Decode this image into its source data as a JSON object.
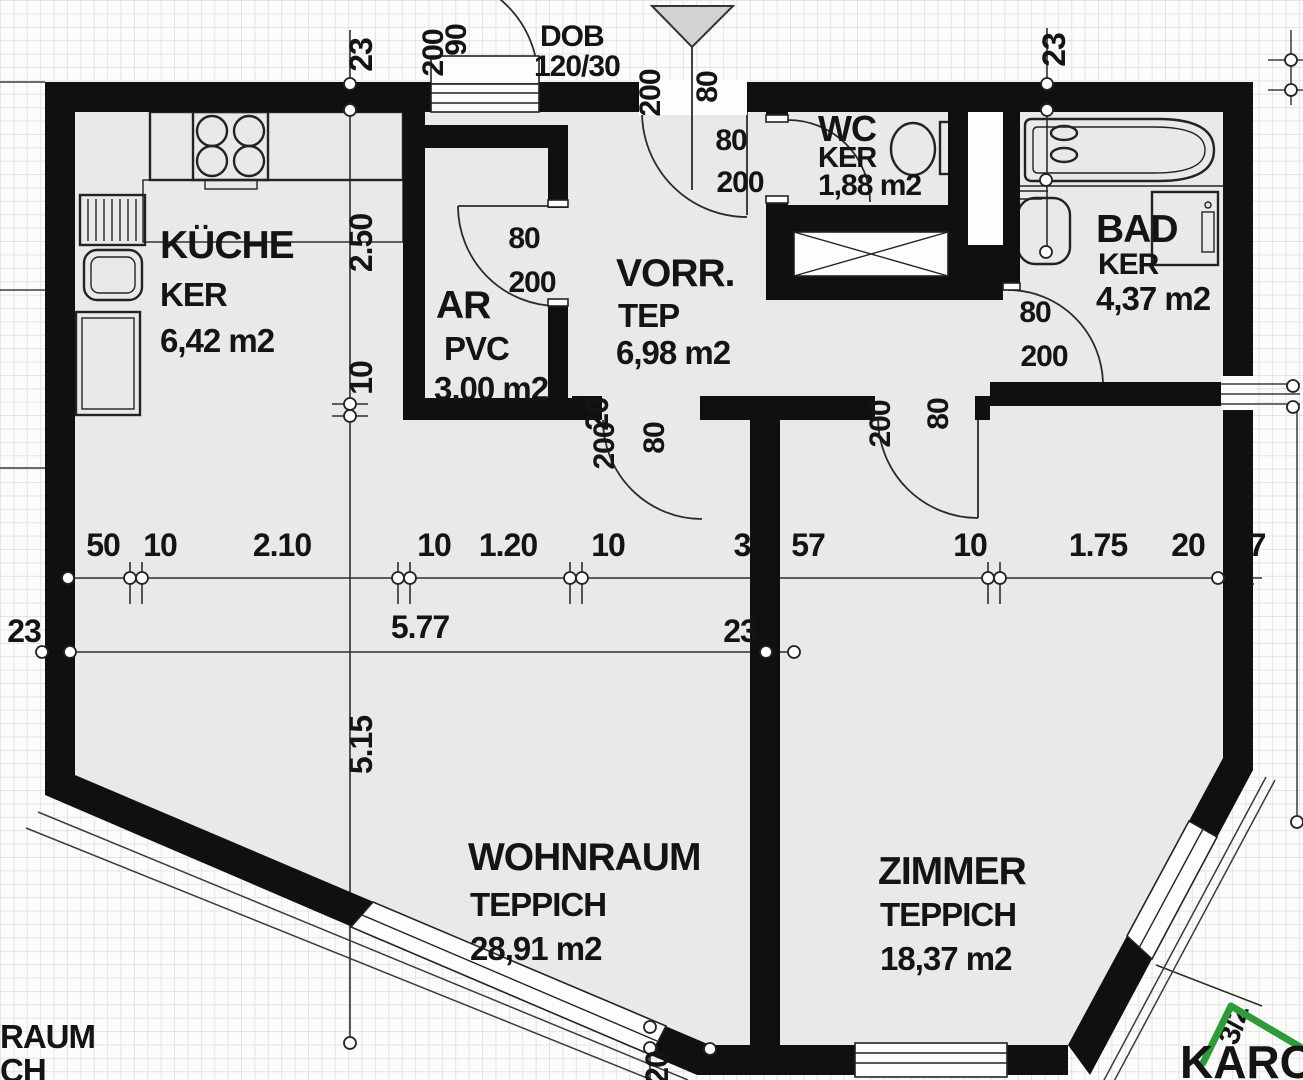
{
  "meta": {
    "title": "Apartment floor plan scan",
    "type": "floorplan"
  },
  "colors": {
    "wall": "#101010",
    "floor": "#e9e9e7",
    "paper": "#fcfcfa",
    "logo_green": "#2e9b38"
  },
  "rooms": {
    "kueche": {
      "name": "KÜCHE",
      "floor": "KER",
      "area": "6,42 m2"
    },
    "ar": {
      "name": "AR",
      "floor": "PVC",
      "area": "3,00 m2"
    },
    "vorraum": {
      "name": "VORR.",
      "floor": "TEP",
      "area": "6,98 m2"
    },
    "wc": {
      "name": "WC",
      "floor": "KER",
      "area": "1,88 m2"
    },
    "bad": {
      "name": "BAD",
      "floor": "KER",
      "area": "4,37 m2"
    },
    "wohnraum": {
      "name": "WOHNRAUM",
      "floor": "TEPPICH",
      "area": "28,91 m2"
    },
    "zimmer": {
      "name": "ZIMMER",
      "floor": "TEPPICH",
      "area": "18,37 m2"
    }
  },
  "dims": {
    "chain": [
      "50",
      "10",
      "2.10",
      "10",
      "1.20",
      "10",
      "3",
      "57",
      "10",
      "1.75",
      "20",
      "7"
    ],
    "total": "5.77",
    "left23": "23",
    "right23": "23",
    "top23l": "23",
    "top23r": "23",
    "v1": "2.50",
    "v2": "10",
    "v3": "5.15",
    "w20a": "20",
    "w20b": "20"
  },
  "doors": {
    "entrance_h": "200",
    "entrance_w": "80",
    "wc_w": "80",
    "wc_h": "200",
    "window_h": "200",
    "window_w": "90",
    "ar_w": "80",
    "ar_h": "200",
    "wohn_h": "200",
    "wohn_w": "80",
    "zimmer_h": "200",
    "zimmer_w": "80",
    "bad_w": "80",
    "bad_h": "200"
  },
  "annotations": {
    "dob_line1": "DOB",
    "dob_line2": "120/30",
    "bay": "3/2",
    "neighbor_line1": "RAUM",
    "neighbor_line2": "CH"
  },
  "logo": {
    "text": "KAROS"
  }
}
